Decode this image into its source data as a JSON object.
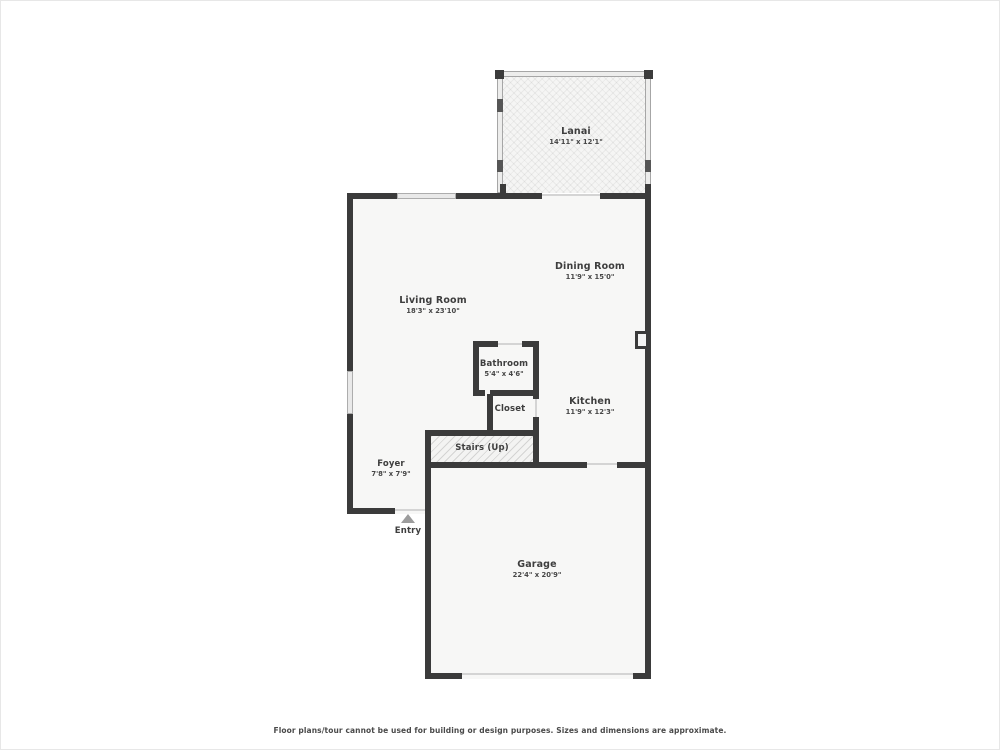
{
  "rooms": {
    "lanai": {
      "name": "Lanai",
      "dims": "14'11\" x 12'1\""
    },
    "living_room": {
      "name": "Living Room",
      "dims": "18'3\" x 23'10\""
    },
    "dining_room": {
      "name": "Dining Room",
      "dims": "11'9\" x 15'0\""
    },
    "bathroom": {
      "name": "Bathroom",
      "dims": "5'4\" x 4'6\""
    },
    "closet": {
      "name": "Closet"
    },
    "kitchen": {
      "name": "Kitchen",
      "dims": "11'9\" x 12'3\""
    },
    "stairs": {
      "name": "Stairs (Up)"
    },
    "foyer": {
      "name": "Foyer",
      "dims": "7'8\" x 7'9\""
    },
    "garage": {
      "name": "Garage",
      "dims": "22'4\" x 20'9\""
    }
  },
  "entry": {
    "label": "Entry"
  },
  "disclaimer": "Floor plans/tour cannot be used for building or design purposes. Sizes and dimensions are approximate.",
  "colors": {
    "wall": "#3b3b3b",
    "floor": "#f7f7f6",
    "window_fill": "#e9e9e9",
    "opening_line": "#d4d4d4",
    "text": "#3e3e3e",
    "entry_arrow": "#9c9c9c"
  }
}
